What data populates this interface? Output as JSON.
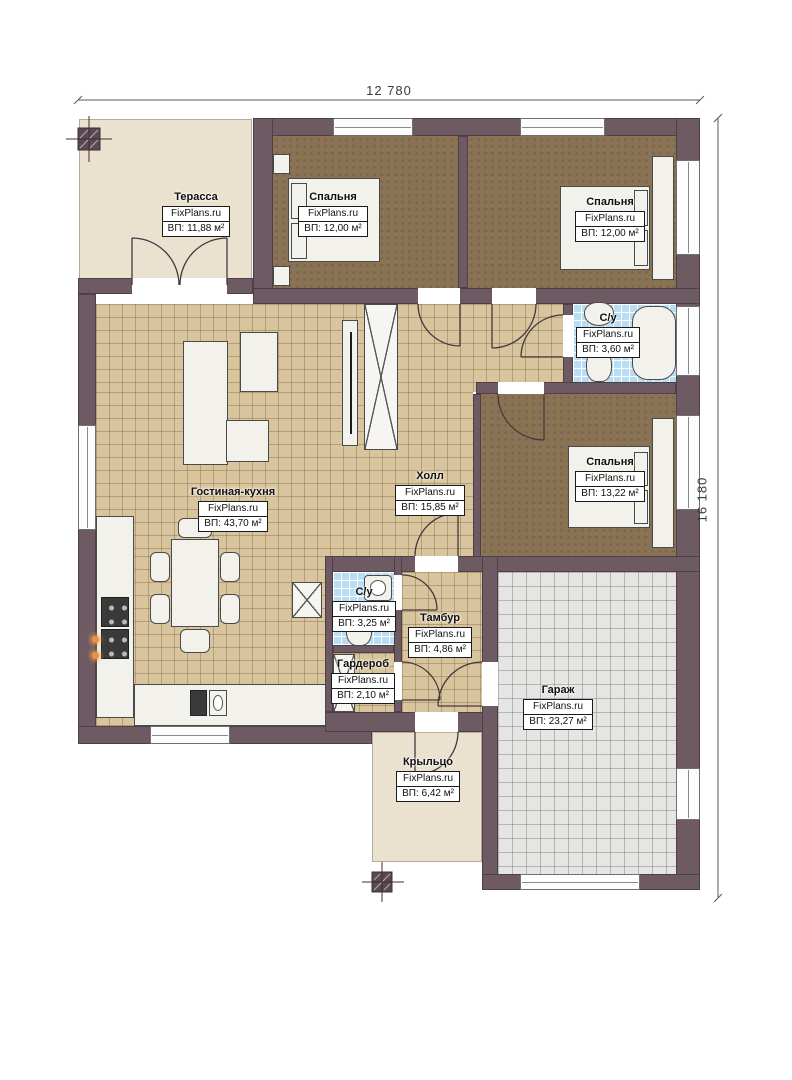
{
  "brand": "FixPlans.ru",
  "dimensions": {
    "top": "12 780",
    "right": "16 180"
  },
  "rooms": {
    "terrace": {
      "name": "Терасса",
      "area": "ВП: 11,88 м²"
    },
    "bedroom1": {
      "name": "Спальня",
      "area": "ВП: 12,00 м²"
    },
    "bedroom2": {
      "name": "Спальня",
      "area": "ВП: 12,00 м²"
    },
    "bathroom1": {
      "name": "С/у",
      "area": "ВП: 3,60 м²"
    },
    "bedroom3": {
      "name": "Спальня",
      "area": "ВП: 13,22 м²"
    },
    "hall": {
      "name": "Холл",
      "area": "ВП: 15,85 м²"
    },
    "living_kitchen": {
      "name": "Гостиная-кухня",
      "area": "ВП: 43,70 м²"
    },
    "bathroom2": {
      "name": "С/у",
      "area": "ВП: 3,25 м²"
    },
    "tambour": {
      "name": "Тамбур",
      "area": "ВП: 4,86 м²"
    },
    "wardrobe": {
      "name": "Гардероб",
      "area": "ВП: 2,10 м²"
    },
    "garage": {
      "name": "Гараж",
      "area": "ВП: 23,27 м²"
    },
    "porch": {
      "name": "Крыльцо",
      "area": "ВП: 6,42 м²"
    }
  },
  "colors": {
    "wall": "#6e5a63",
    "tile_floor": "#d9c59d",
    "wood_floor": "#8a7355",
    "bath_floor": "#b9ddf3",
    "garage_floor": "#e5e5e3",
    "terrace_floor": "#eae1cf",
    "accent_orange": "#ef8f3f"
  }
}
